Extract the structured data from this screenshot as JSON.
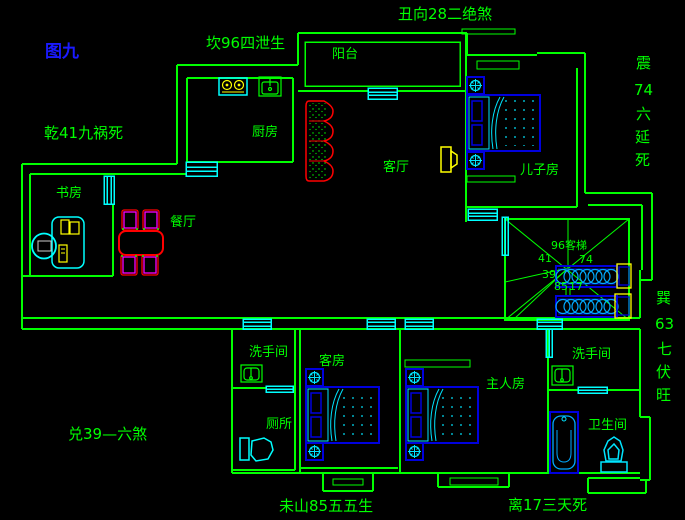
{
  "title": {
    "figure": "图九"
  },
  "fengshui": {
    "north": "坎96四泄生",
    "facing": "丑向28二绝煞",
    "northwest": "乾41九祸死",
    "west": "兑39—六煞",
    "mountain": "未山85五五生",
    "south": "离17三天死",
    "east": [
      "震",
      "74",
      "六",
      "延",
      "死"
    ],
    "southeast": [
      "巽",
      "63",
      "七",
      "伏",
      "旺"
    ]
  },
  "rooms": {
    "balcony": "阳台",
    "kitchen": "厨房",
    "living": "客厅",
    "son": "儿子房",
    "study": "书房",
    "dining": "餐厅",
    "washroom1": "洗手间",
    "toilet": "厕所",
    "guest": "客房",
    "master": "主人房",
    "washroom2": "洗手间",
    "bathroom": "卫生间"
  },
  "stairwell": {
    "label": "96客梯",
    "n41": "41",
    "n74": "74",
    "n39": "39",
    "n85": "85",
    "n17": "17"
  },
  "colors": {
    "background": "#000000",
    "wall_green": "#00ff00",
    "window_cyan": "#00ffff",
    "furniture_blue": "#0000dd",
    "detail_cyan": "#00e5ff",
    "accent_yellow": "#ffff00",
    "sofa_red": "#ff0000",
    "chair_magenta": "#ff00ff",
    "title_blue": "#1a1aff"
  }
}
